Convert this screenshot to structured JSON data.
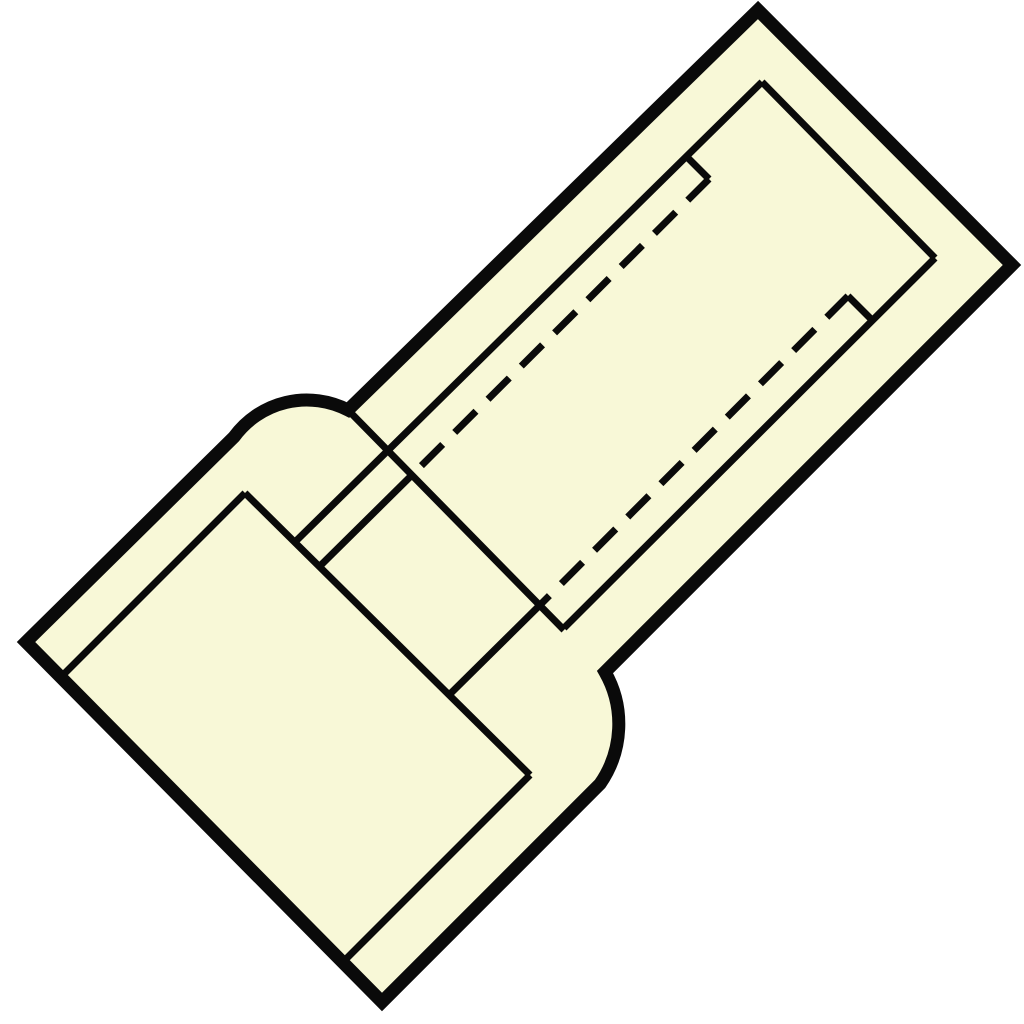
{
  "figure": {
    "kind": "technical-line-drawing",
    "subject": "insulated-butt-connector",
    "background_color": "#ffffff",
    "body_fill_color": "#f8f8d7",
    "line_color": "#0a0a0a",
    "outer_stroke_width": 13,
    "inner_stroke_width": 7,
    "dash_pattern": "30 17",
    "viewbox": "0 0 1024 1024",
    "outline": {
      "name": "connector-body-outline",
      "d": "M 758 10 L 1012 265 L 605 672 A 105 105 0 0 1 600 784 L 382 1002 L 26 642 L 234 437 A 90 90 0 0 1 348 410 Z"
    },
    "solid_lines": [
      {
        "name": "barrel-end-inner-edge",
        "d": "M 762 82 L 935 258"
      },
      {
        "name": "barrel-upper-inner-edge",
        "d": "M 762 82 L 296 541"
      },
      {
        "name": "barrel-upper-step",
        "d": "M 688 158 L 709 179"
      },
      {
        "name": "barrel-lower-inner-edge",
        "d": "M 935 258 L 564 628"
      },
      {
        "name": "barrel-lower-step",
        "d": "M 872 320 L 848 296"
      },
      {
        "name": "barrel-end-face-edge",
        "d": "M 348 410 L 564 630"
      },
      {
        "name": "sleeve-inner-end-edge",
        "d": "M 245 493 L 530 775"
      },
      {
        "name": "sleeve-opening-upper-edge",
        "d": "M 245 493 L 65 673"
      },
      {
        "name": "sleeve-opening-lower-edge",
        "d": "M 530 775 L 345 960"
      },
      {
        "name": "bore-upper-visible-edge",
        "d": "M 412 475 L 320 566"
      },
      {
        "name": "bore-lower-visible-edge",
        "d": "M 541 604 L 449 695"
      }
    ],
    "dashed_lines": [
      {
        "name": "bore-upper-hidden-edge",
        "d": "M 709 179 L 412 475"
      },
      {
        "name": "bore-lower-hidden-edge",
        "d": "M 848 296 L 541 604"
      }
    ]
  }
}
